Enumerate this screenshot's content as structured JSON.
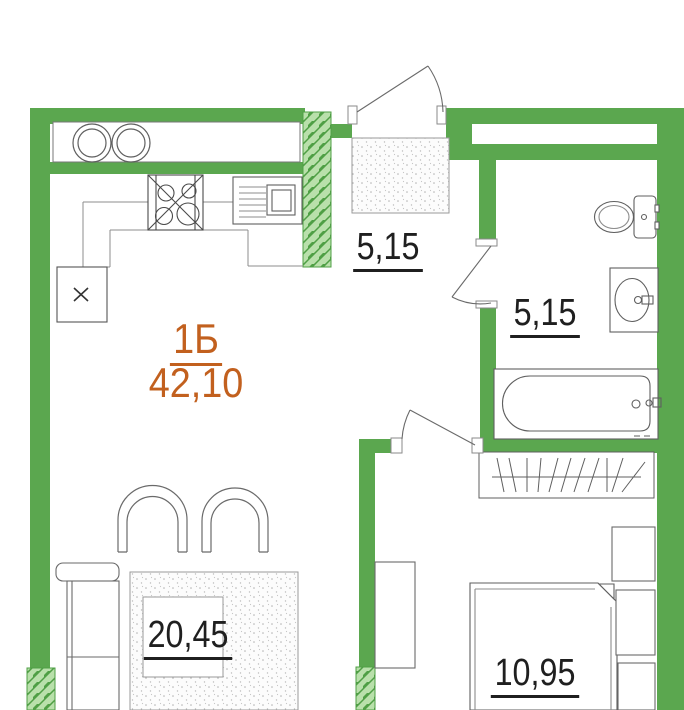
{
  "plan": {
    "apartment": {
      "type_label": "1Б",
      "total_area": "42,10"
    },
    "rooms": [
      {
        "id": "hallway",
        "area_label": "5,15"
      },
      {
        "id": "bathroom",
        "area_label": "5,15"
      },
      {
        "id": "living-kitchen",
        "area_label": "20,45"
      },
      {
        "id": "bedroom",
        "area_label": "10,95"
      }
    ],
    "colors": {
      "wall_green": "#5BA74F",
      "hatch_fill": "#B9E0AB",
      "hatch_line": "#4F9F45",
      "accent_orange": "#C2601E",
      "fixture_stroke": "#5F5F5F",
      "label_text": "#1F1F1F"
    },
    "fixture_symbols": [
      "entrance-door",
      "hall-door",
      "bathroom-door",
      "hob-rings",
      "gas-stove",
      "kitchen-sink",
      "appliance-box",
      "toilet",
      "washbasin",
      "bathtub",
      "closet-hatch",
      "hall-cabinet",
      "sofa",
      "armchair",
      "armchair",
      "rug",
      "coffee-table",
      "bed",
      "nightstand",
      "nightstand",
      "desk",
      "wardrobe"
    ]
  }
}
